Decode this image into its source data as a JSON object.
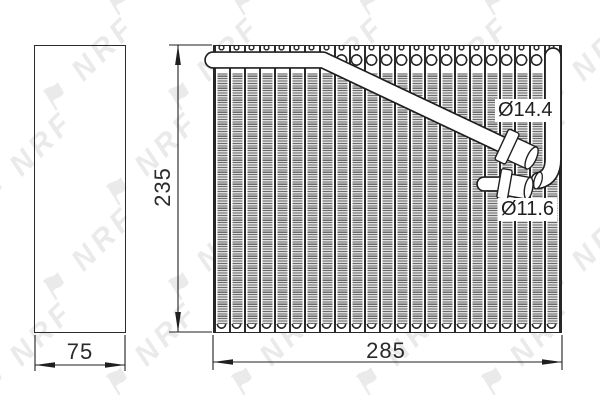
{
  "drawing": {
    "watermark": {
      "brand": "NRF",
      "flag_glyph": "⚑"
    },
    "dimensions": {
      "height": "235",
      "width": "285",
      "depth": "75"
    },
    "ports": {
      "upper_diameter": "Ø14.4",
      "lower_diameter": "Ø11.6"
    },
    "colors": {
      "line": "#1f1f1f",
      "fin_dark": "#6b6b6b",
      "fin_light": "#dcdcdc",
      "watermark": "#eaeaea",
      "background": "#ffffff"
    }
  }
}
